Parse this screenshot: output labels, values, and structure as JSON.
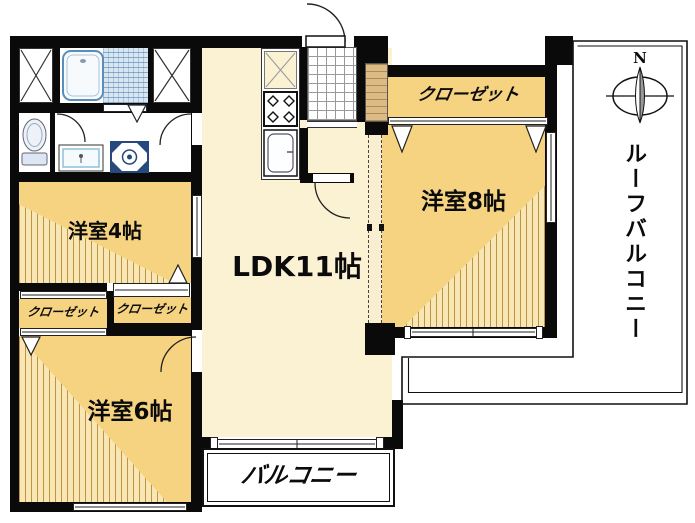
{
  "plan": {
    "type": "apartment-floor-plan",
    "rooms": {
      "ldk": {
        "label": "LDK11帖"
      },
      "western_4": {
        "label": "洋室4帖"
      },
      "western_6": {
        "label": "洋室6帖"
      },
      "western_8": {
        "label": "洋室8帖"
      },
      "closet_8": {
        "label": "クローゼット"
      },
      "closet_4": {
        "label": "クローゼット"
      },
      "closet_6": {
        "label": "クローゼット"
      },
      "balcony": {
        "label": "バルコニー"
      },
      "roof_balcony": {
        "label": "ルーフバルコニー"
      }
    },
    "compass": {
      "north": "N"
    },
    "fixtures": [
      "bathtub",
      "bathroom-tile",
      "toilet",
      "vanity-sink",
      "washing-machine",
      "storage-x",
      "storage-x",
      "refrigerator-space",
      "gas-stove",
      "kitchen-sink",
      "entrance-tile",
      "shoe-cabinet",
      "entrance-door"
    ],
    "colors": {
      "wall_black": "#0a0a0a",
      "room_yellow": "#F5D381",
      "room_hatch_line": "#BE9440",
      "hatch_base": "#F8E6B4",
      "ldk_cream": "#FBF1D3",
      "tile_blue": "#D7E6F0",
      "wood_tan": "#DCBC84",
      "washer_navy": "#26497E",
      "tub_blue": "#5B8DB8"
    }
  }
}
